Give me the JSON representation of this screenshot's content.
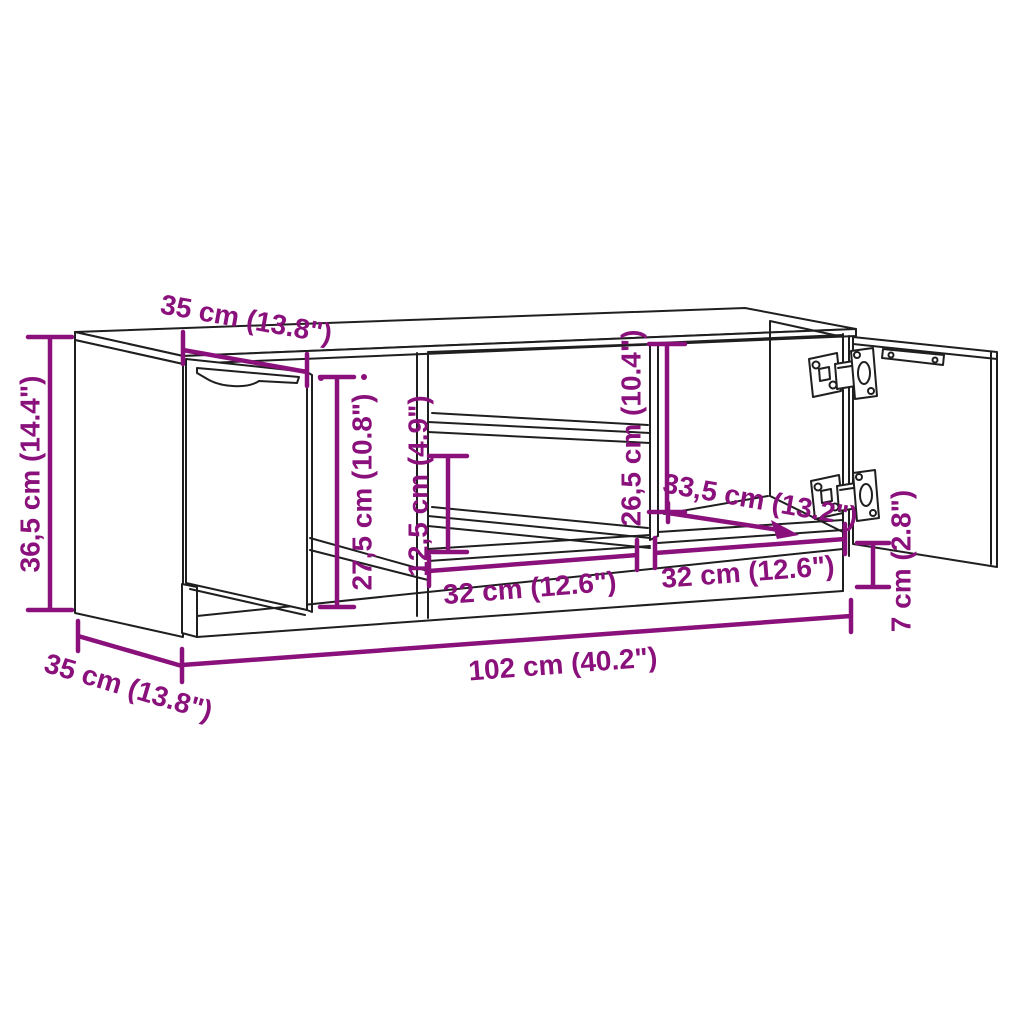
{
  "background_color": "#ffffff",
  "line_color": "#1f1f1f",
  "dimension_color": "#8a107b",
  "dimensions": {
    "top_depth": "35 cm (13.8\")",
    "overall_height": "36,5 cm (14.4\")",
    "door_height": "27,5 cm (10.8\")",
    "shelf_spacing": "12,5 cm (4.9\")",
    "side_opening_height": "26,5 cm (10.4\")",
    "interior_depth": "33,5 cm (13.2\")",
    "base_height": "7 cm (2.8\")",
    "left_opening_width": "32 cm (12.6\")",
    "right_opening_width": "32 cm (12.6\")",
    "overall_width": "102 cm (40.2\")",
    "base_depth": "35 cm (13.8\")"
  }
}
